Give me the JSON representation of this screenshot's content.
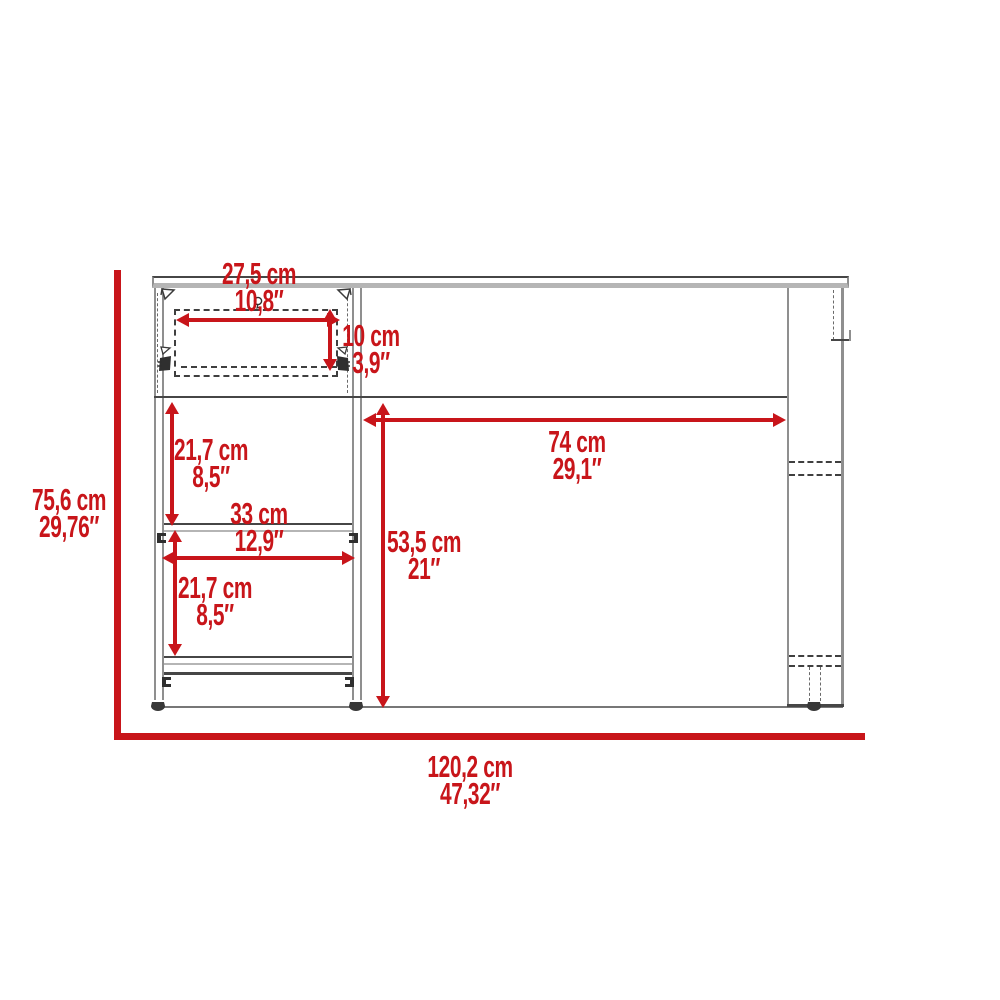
{
  "diagram": {
    "type": "furniture-dimension-drawing",
    "subject": "desk with drawer, two shelves and panel leg, front elevation",
    "units": [
      "cm",
      "inches"
    ],
    "accent_color": "#c8151a",
    "line_color": "#464646",
    "dimensions": {
      "overall_height": {
        "cm": "75,6 cm",
        "in": "29,76″"
      },
      "overall_width": {
        "cm": "120,2 cm",
        "in": "47,32″"
      },
      "drawer_width": {
        "cm": "27,5 cm",
        "in": "10,8″"
      },
      "drawer_height": {
        "cm": "10 cm",
        "in": "3,9″"
      },
      "upper_shelf_space_height": {
        "cm": "21,7 cm",
        "in": "8,5″"
      },
      "shelf_width": {
        "cm": "33 cm",
        "in": "12,9″"
      },
      "lower_shelf_space_height": {
        "cm": "21,7 cm",
        "in": "8,5″"
      },
      "knee_space_width": {
        "cm": "74 cm",
        "in": "29,1″"
      },
      "knee_space_height": {
        "cm": "53,5 cm",
        "in": "21″"
      }
    }
  }
}
